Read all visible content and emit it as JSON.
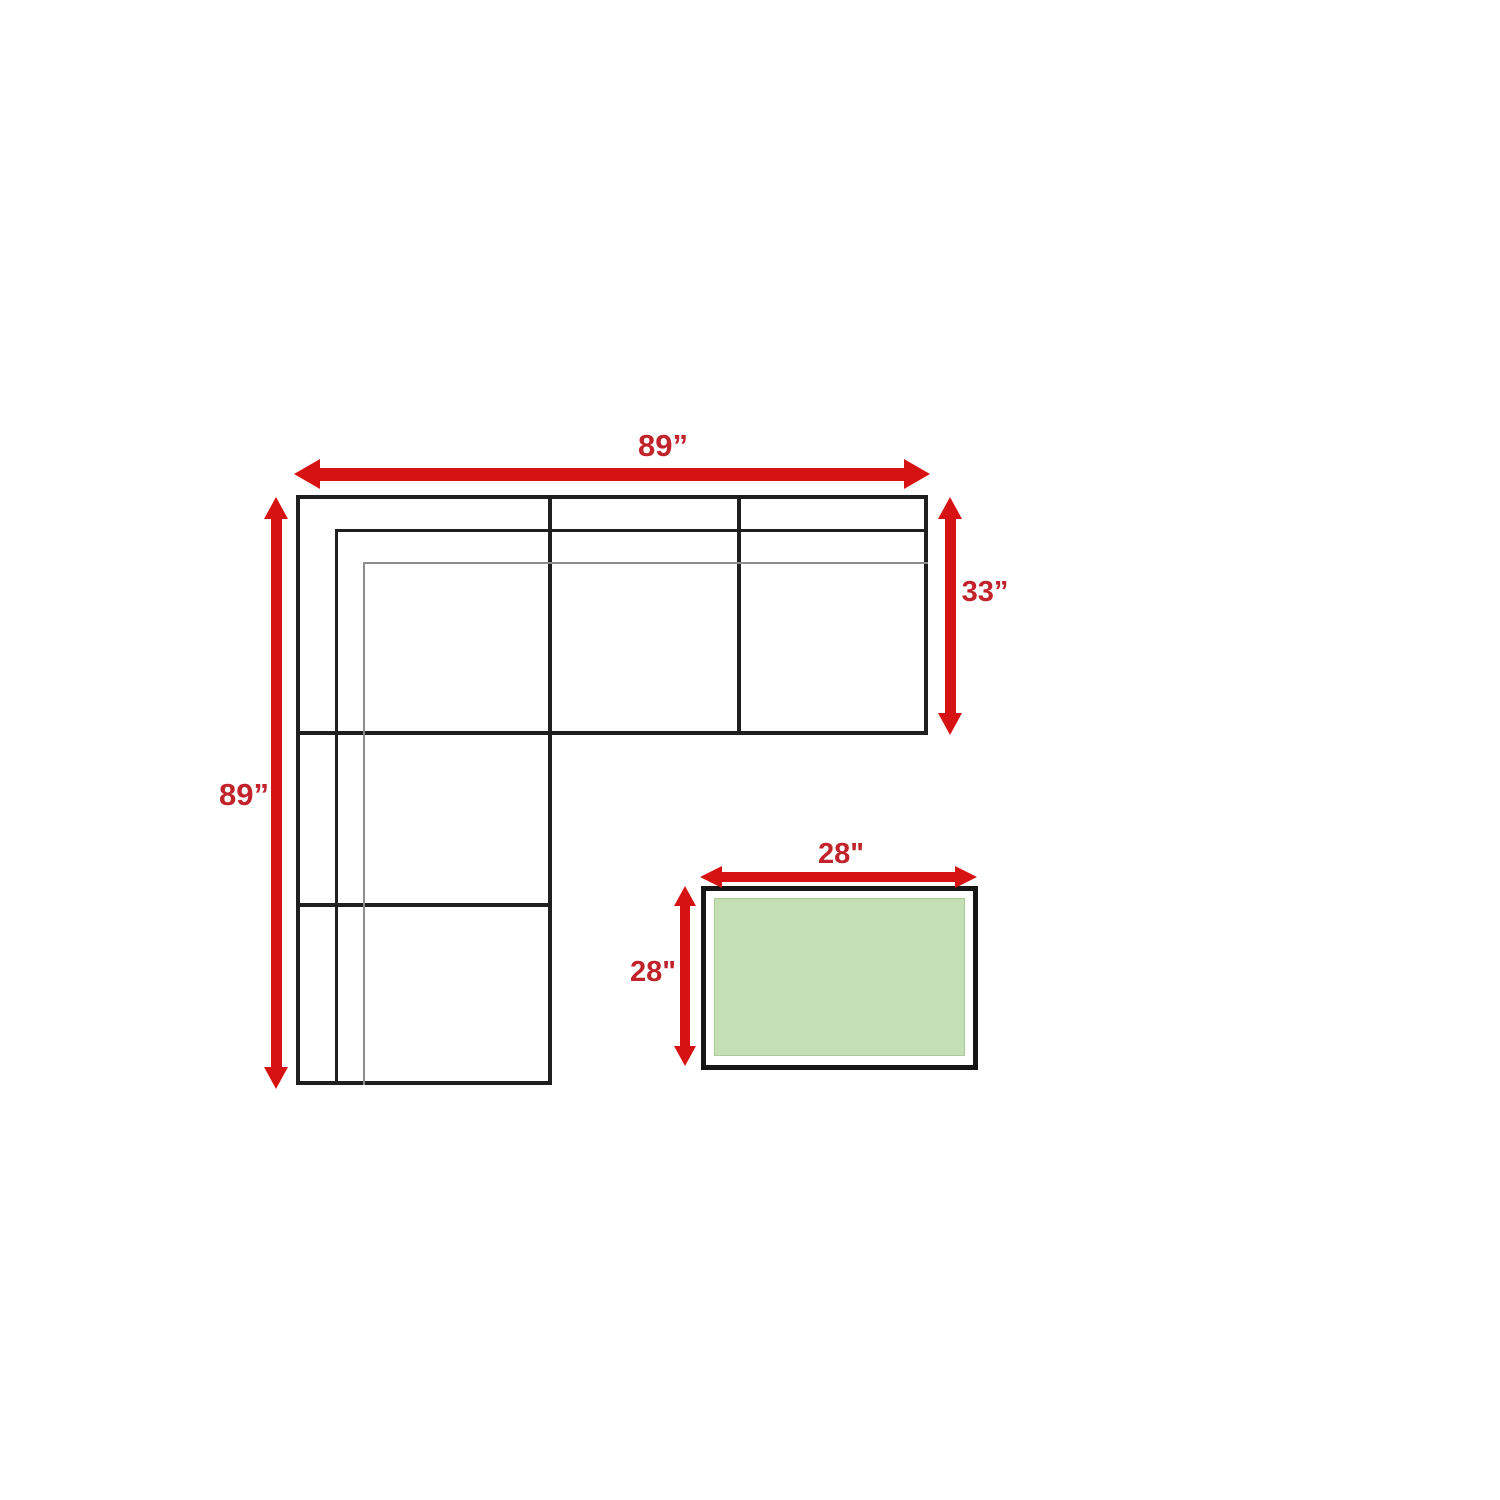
{
  "diagram": {
    "sofa": {
      "width_label": "89”",
      "right_depth_label": "33”",
      "left_length_label": "89”"
    },
    "table": {
      "width_label": "28\"",
      "depth_label": "28\""
    },
    "colors": {
      "arrow_red": "#d61212",
      "label_red": "#c2222a",
      "sofa_line": "#1f1f1f",
      "thin_line": "#8c8c8c",
      "table_fill": "#c5dfb5",
      "table_border": "#161616",
      "background": "#ffffff"
    }
  }
}
